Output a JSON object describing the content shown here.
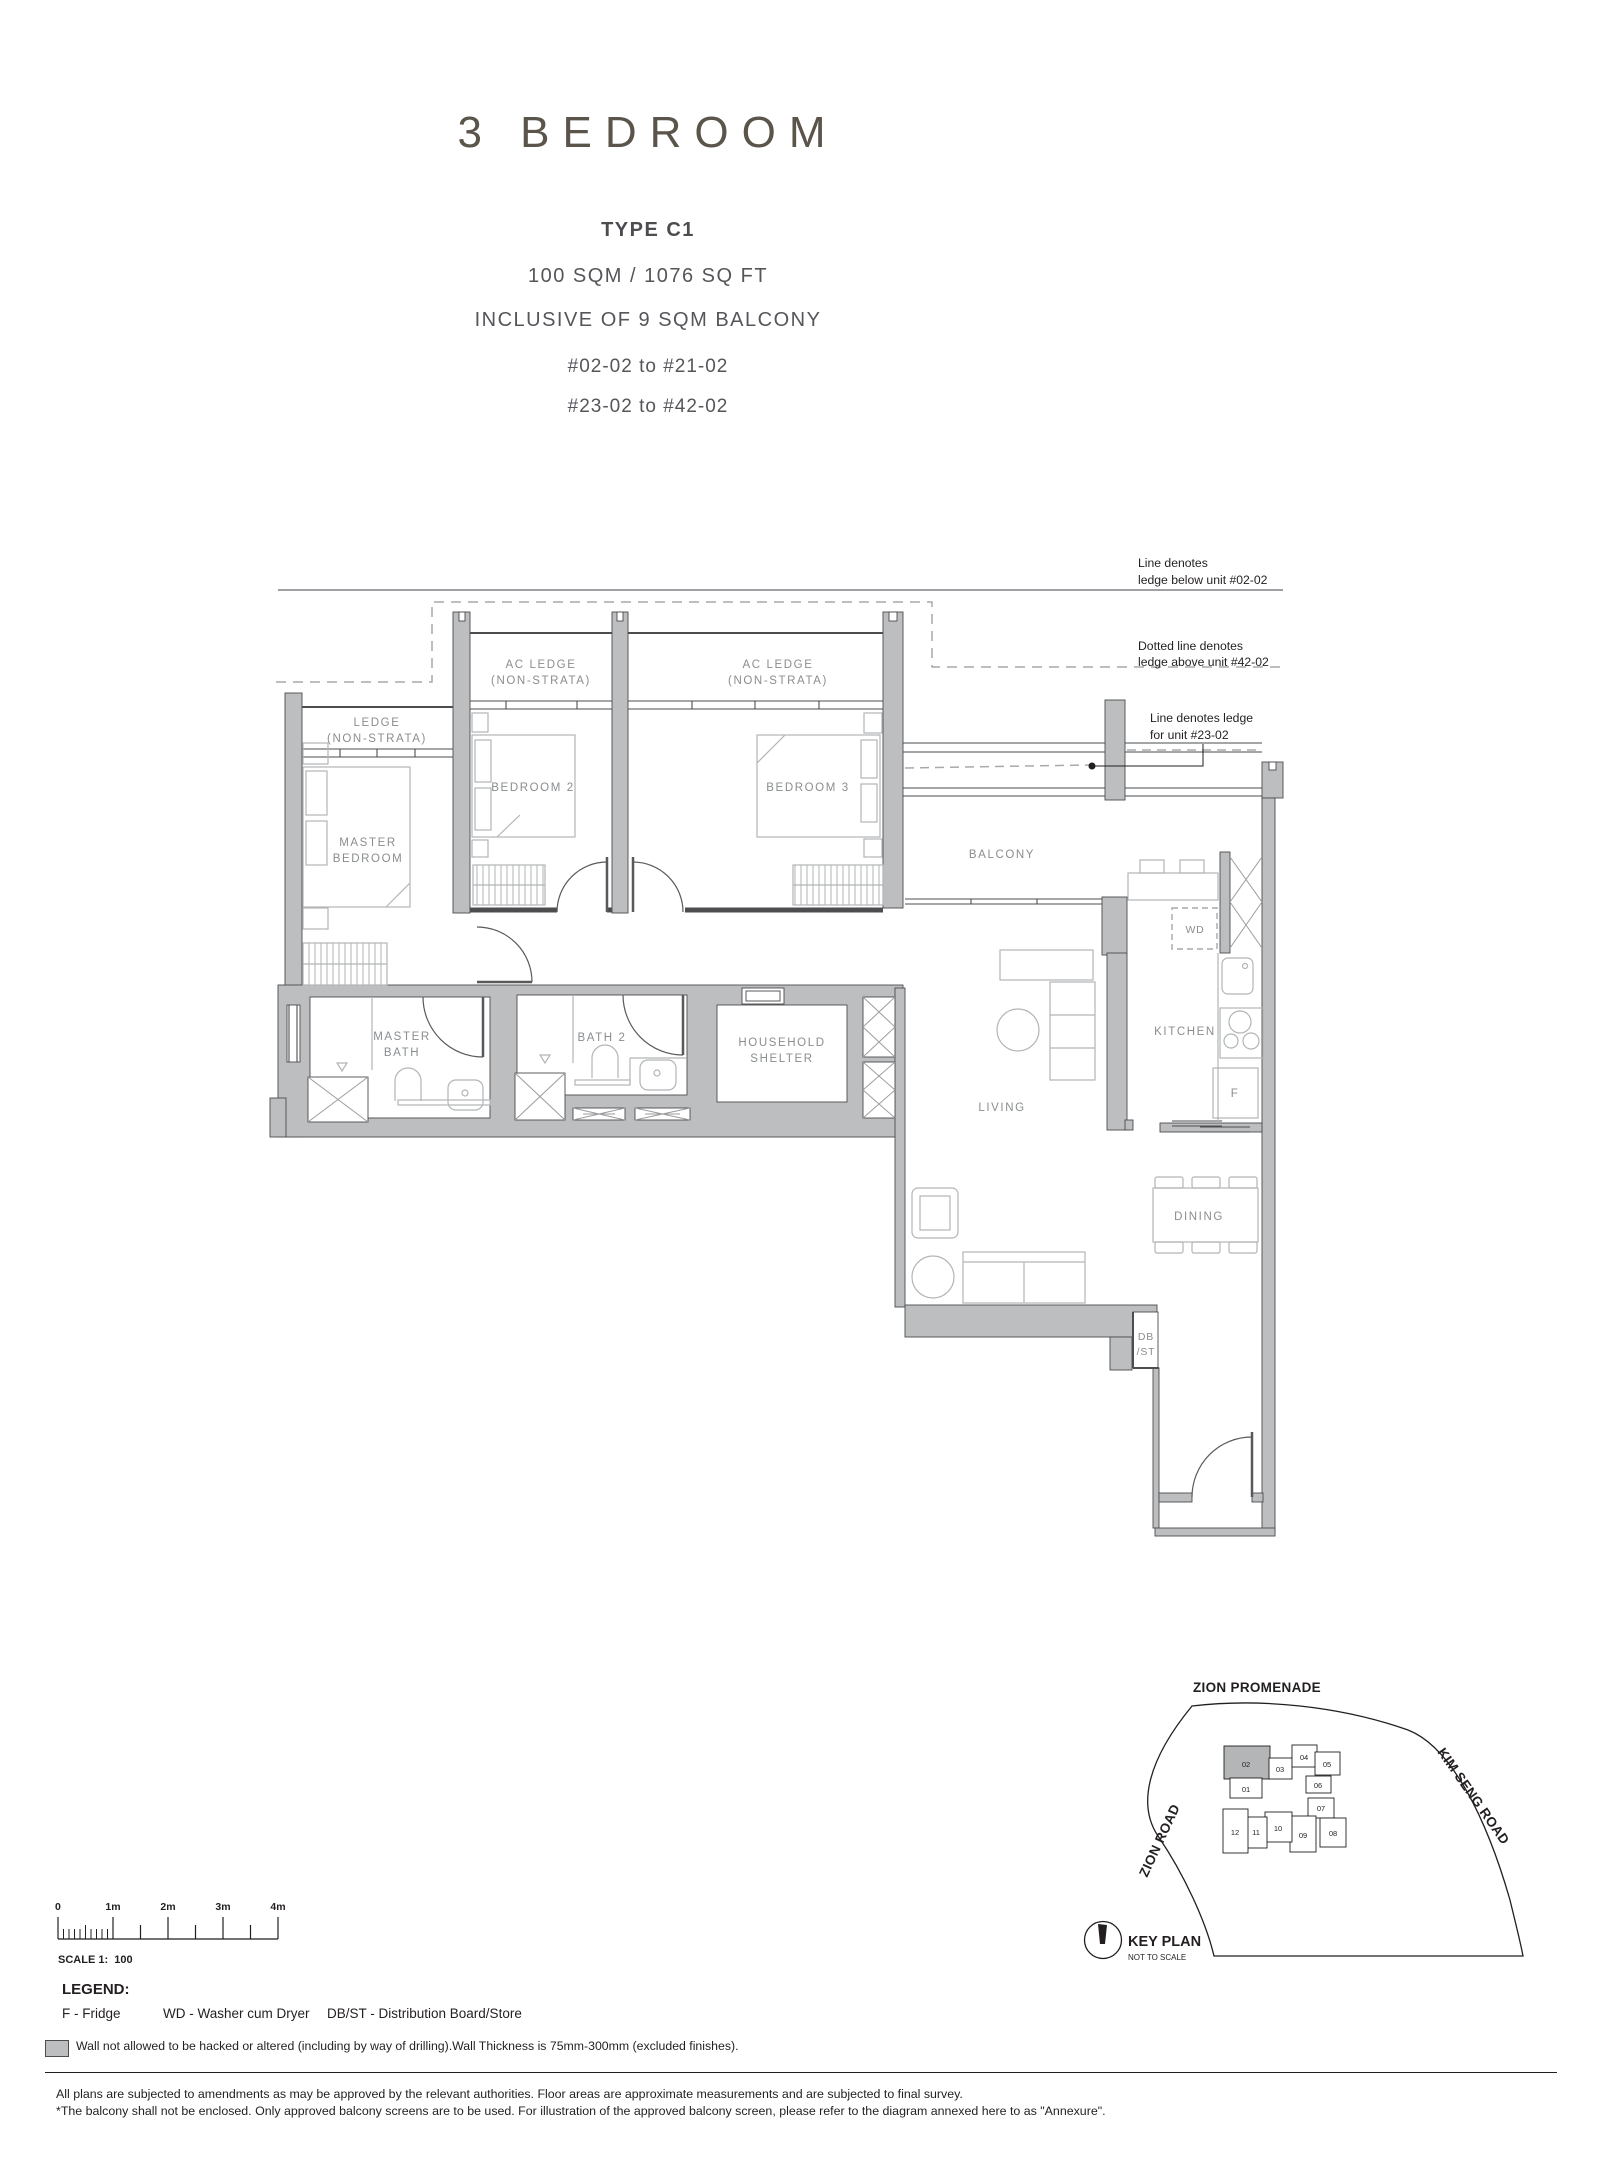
{
  "header": {
    "title": "3 BEDROOM",
    "type": "TYPE C1",
    "area": "100 SQM / 1076 SQ FT",
    "balcony": "INCLUSIVE OF 9 SQM BALCONY",
    "stack_range_1": "#02-02 to #21-02",
    "stack_range_2": "#23-02 to #42-02"
  },
  "annotations": {
    "ledge_below": [
      "Line denotes",
      "ledge below unit #02-02"
    ],
    "ledge_above": [
      "Dotted line denotes",
      "ledge above unit #42-02"
    ],
    "ledge_for": [
      "Line denotes ledge",
      "for unit #23-02"
    ]
  },
  "rooms": {
    "ledge": [
      "LEDGE",
      "(NON-STRATA)"
    ],
    "ac_ledge_1": [
      "AC LEDGE",
      "(NON-STRATA)"
    ],
    "ac_ledge_2": [
      "AC LEDGE",
      "(NON-STRATA)"
    ],
    "master_bedroom": [
      "MASTER",
      "BEDROOM"
    ],
    "bedroom_2": "BEDROOM 2",
    "bedroom_3": "BEDROOM 3",
    "balcony": "BALCONY",
    "master_bath": [
      "MASTER",
      "BATH"
    ],
    "bath_2": "BATH 2",
    "household_shelter": [
      "HOUSEHOLD",
      "SHELTER"
    ],
    "living": "LIVING",
    "kitchen": "KITCHEN",
    "dining": "DINING",
    "wd": "WD",
    "fridge": "F",
    "dbst": [
      "DB",
      "/ST"
    ]
  },
  "scale_bar": {
    "labels": [
      "0",
      "1m",
      "2m",
      "3m",
      "4m"
    ],
    "scale_text": "SCALE 1:  100"
  },
  "key_plan": {
    "road_top": "ZION PROMENADE",
    "road_right": "KIM SENG ROAD",
    "road_left": "ZION ROAD",
    "title": "KEY PLAN",
    "subtitle": "NOT TO SCALE",
    "highlighted_block": "02",
    "blocks": [
      "01",
      "02",
      "03",
      "04",
      "05",
      "06",
      "07",
      "08",
      "09",
      "10",
      "11",
      "12"
    ]
  },
  "legend": {
    "title": "LEGEND:",
    "items": [
      "F - Fridge",
      "WD - Washer cum Dryer",
      "DB/ST - Distribution Board/Store"
    ],
    "wall_note": "Wall not allowed to be hacked or altered (including by way of drilling).Wall Thickness is 75mm-300mm (excluded finishes)."
  },
  "footer": {
    "line1": "All plans are subjected to amendments as may be approved by the relevant authorities. Floor areas are approximate measurements and are subjected to final survey.",
    "line2": "*The balcony shall not be enclosed. Only approved balcony screens are to be used. For illustration of the approved balcony screen, please refer to the diagram annexed here to as \"Annexure\"."
  },
  "colors": {
    "wall": "#bcbec0",
    "wall_outline": "#4d4d4f",
    "label": "#8a8d8f",
    "ink": "#231f20",
    "highlight_block": "#b3b5b7"
  }
}
